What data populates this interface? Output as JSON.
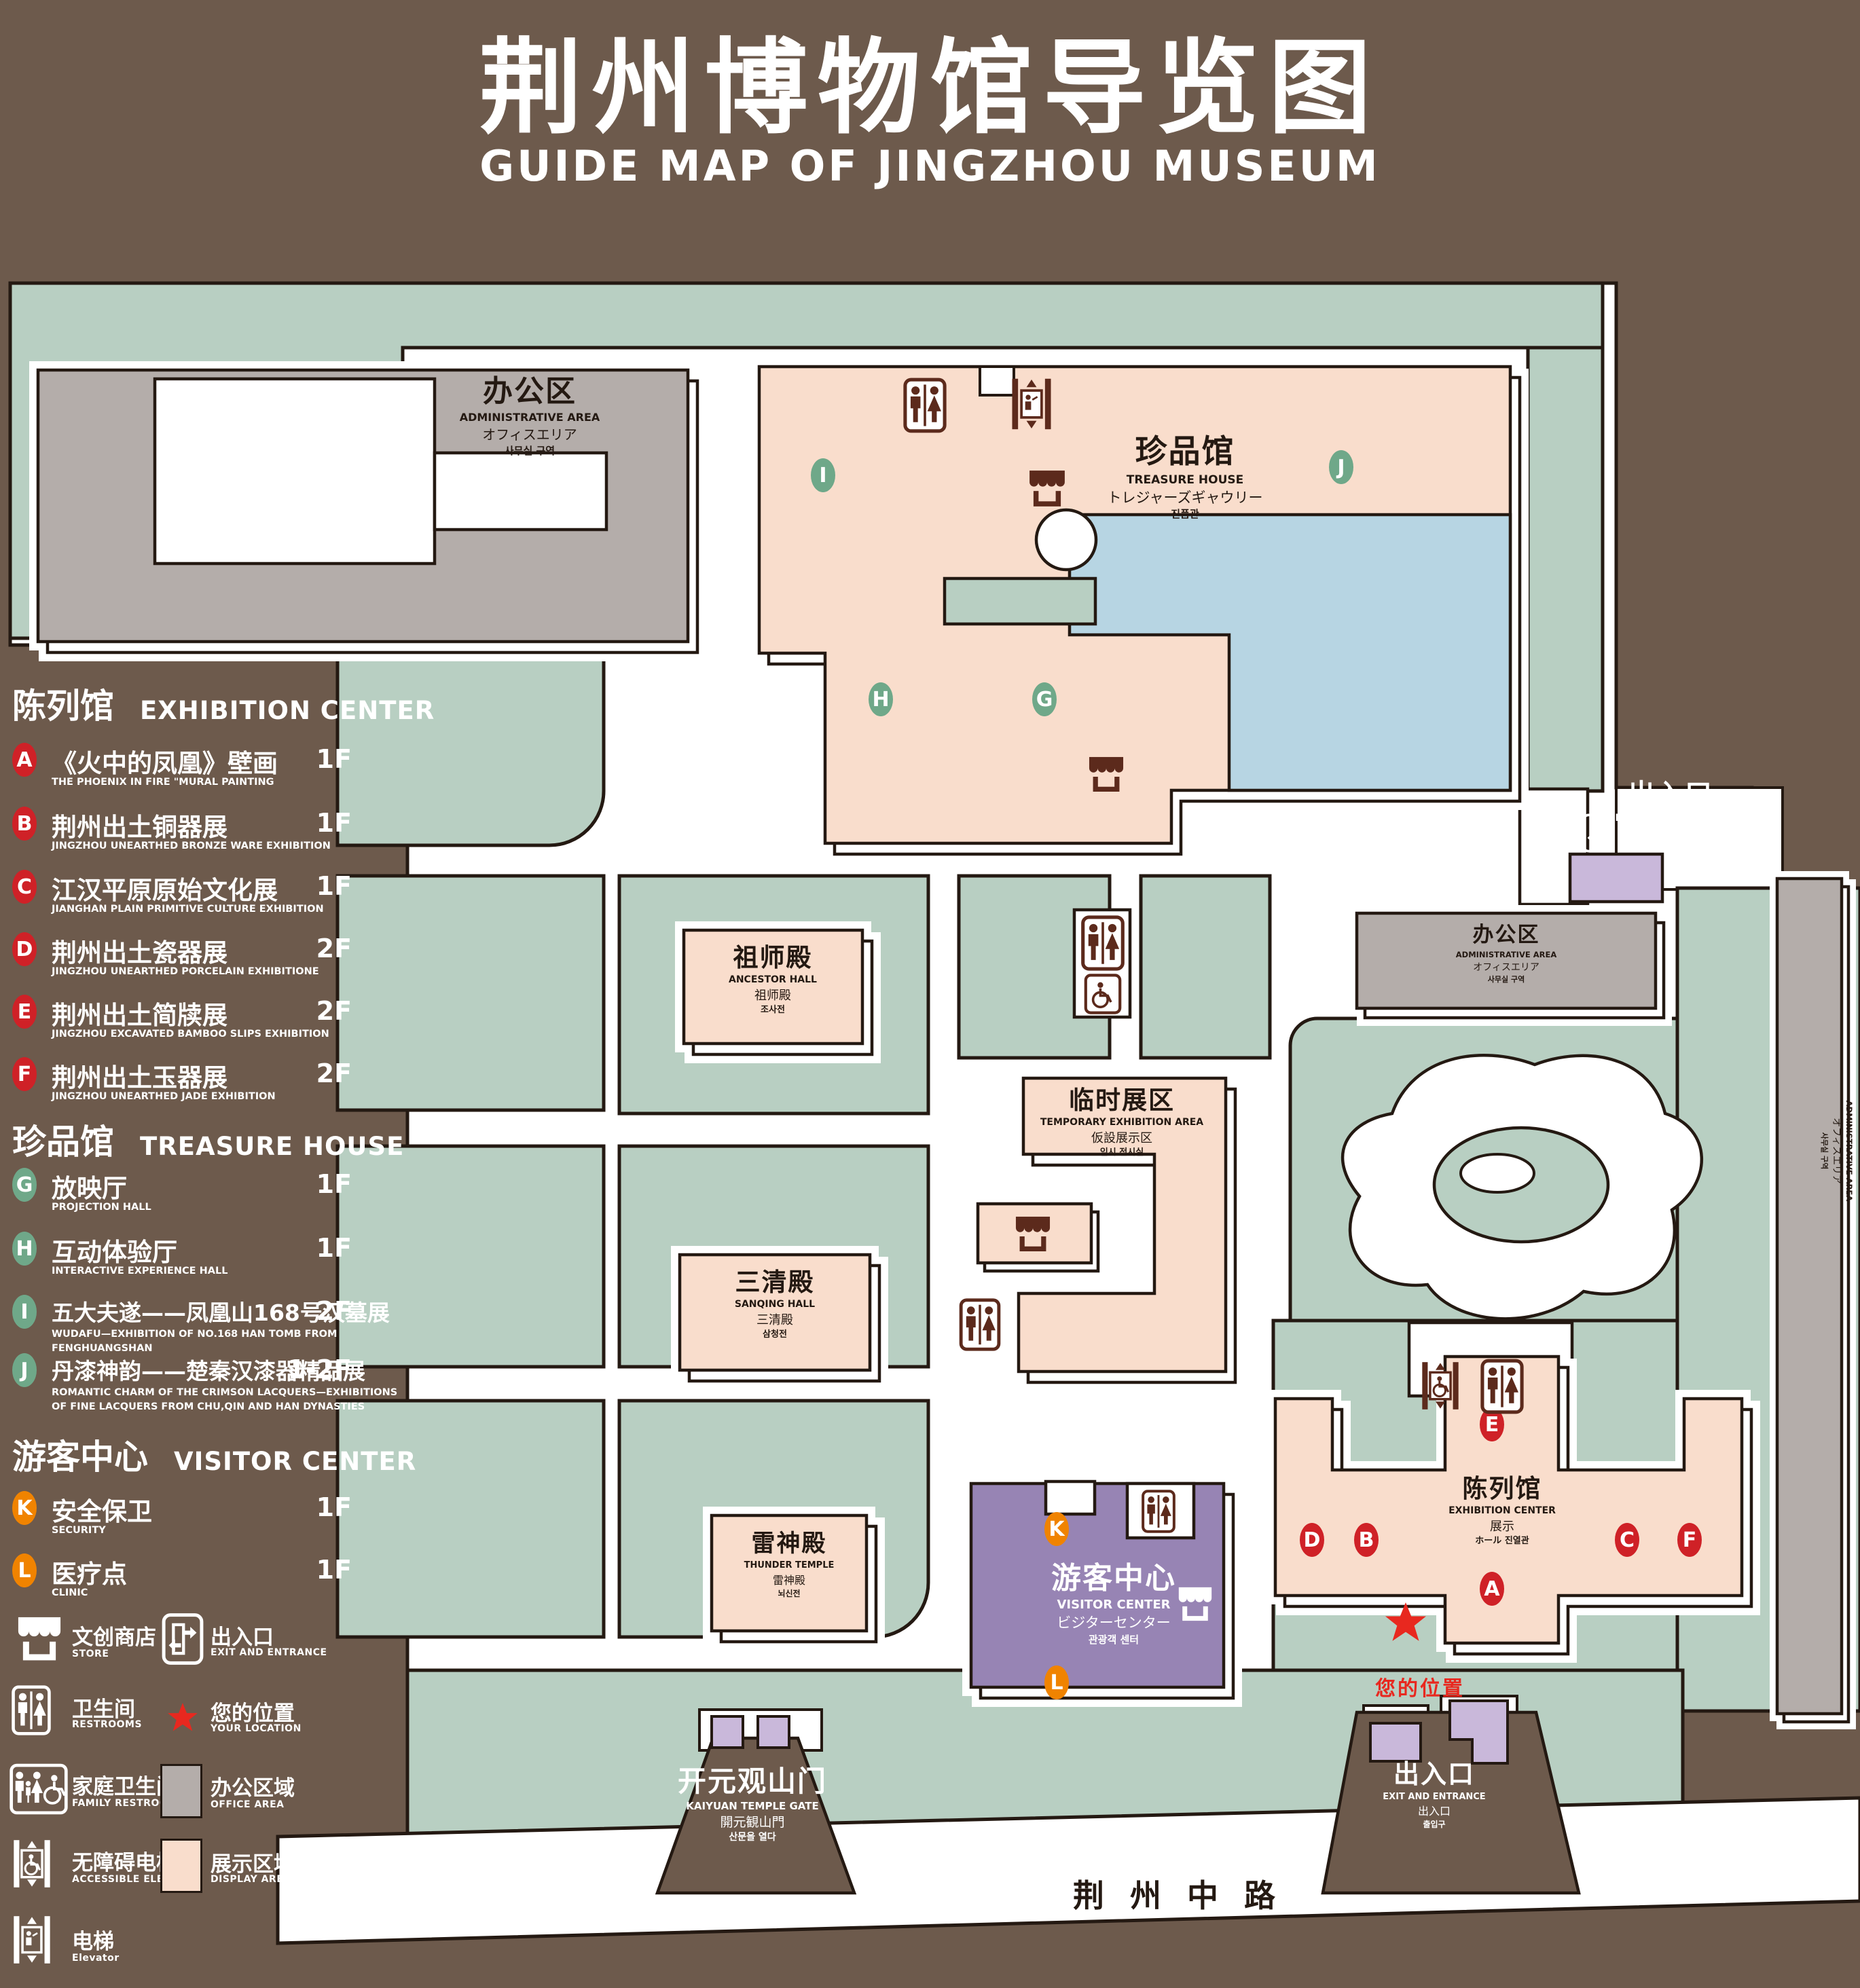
{
  "title": {
    "cn": "荆州博物馆导览图",
    "en": "GUIDE MAP OF JINGZHOU MUSEUM"
  },
  "legend": {
    "sections": [
      {
        "cn": "陈列馆",
        "en": "EXHIBITION CENTER"
      },
      {
        "cn": "珍品馆",
        "en": "TREASURE HOUSE"
      },
      {
        "cn": "游客中心",
        "en": "VISITOR CENTER"
      }
    ],
    "items": [
      {
        "code": "A",
        "cn": "《火中的凤凰》壁画",
        "en": "THE PHOENIX IN FIRE \"MURAL PAINTING",
        "floor": "1F"
      },
      {
        "code": "B",
        "cn": "荆州出土铜器展",
        "en": "JINGZHOU UNEARTHED BRONZE WARE EXHIBITION",
        "floor": "1F"
      },
      {
        "code": "C",
        "cn": "江汉平原原始文化展",
        "en": "JIANGHAN PLAIN PRIMITIVE CULTURE EXHIBITION",
        "floor": "1F"
      },
      {
        "code": "D",
        "cn": "荆州出土瓷器展",
        "en": "JINGZHOU UNEARTHED PORCELAIN EXHIBITIONE",
        "floor": "2F"
      },
      {
        "code": "E",
        "cn": "荆州出土简牍展",
        "en": "JINGZHOU EXCAVATED BAMBOO SLIPS EXHIBITION",
        "floor": "2F"
      },
      {
        "code": "F",
        "cn": "荆州出土玉器展",
        "en": "JINGZHOU UNEARTHED JADE EXHIBITION",
        "floor": "2F"
      },
      {
        "code": "G",
        "cn": "放映厅",
        "en": "PROJECTION HALL",
        "floor": "1F"
      },
      {
        "code": "H",
        "cn": "互动体验厅",
        "en": "INTERACTIVE EXPERIENCE HALL",
        "floor": "1F"
      },
      {
        "code": "I",
        "cn": "五大夫遂——凤凰山168号汉墓展",
        "en": "WUDAFU—EXHIBITION OF NO.168 HAN TOMB FROM FENGHUANGSHAN",
        "floor": "2F"
      },
      {
        "code": "J",
        "cn": "丹漆神韵——楚秦汉漆器精品展",
        "en": "ROMANTIC CHARM OF THE CRIMSON LACQUERS—EXHIBITIONS OF FINE LACQUERS FROM CHU,QIN AND HAN DYNASTIES",
        "floor": "1-2F"
      },
      {
        "code": "K",
        "cn": "安全保卫",
        "en": "SECURITY",
        "floor": "1F"
      },
      {
        "code": "L",
        "cn": "医疗点",
        "en": "CLINIC",
        "floor": "1F"
      }
    ],
    "symbols": [
      {
        "icon": "store-icon",
        "cn": "文创商店",
        "en": "STORE"
      },
      {
        "icon": "exit-icon",
        "cn": "出入口",
        "en": "EXIT AND ENTRANCE"
      },
      {
        "icon": "restroom-icon",
        "cn": "卫生间",
        "en": "RESTROOMS"
      },
      {
        "icon": "location-star-icon",
        "cn": "您的位置",
        "en": "YOUR LOCATION"
      },
      {
        "icon": "family-restroom-icon",
        "cn": "家庭卫生间",
        "en": "FAMILY RESTROOMS"
      },
      {
        "icon": "office-area-swatch",
        "cn": "办公区域",
        "en": "OFFICE AREA",
        "color": "#b4adaa"
      },
      {
        "icon": "accessible-elevator-icon",
        "cn": "无障碍电梯",
        "en": "ACCESSIBLE ELEVATOR"
      },
      {
        "icon": "display-area-swatch",
        "cn": "展示区域",
        "en": "DISPLAY AREA",
        "color": "#f9ddcc"
      },
      {
        "icon": "elevator-icon",
        "cn": "电梯",
        "en": "Elevator"
      }
    ]
  },
  "map": {
    "buildings": {
      "admin_top_left": {
        "cn": "办公区",
        "en": "ADMINISTRATIVE AREA",
        "jp": "オフィスエリア",
        "kr": "사무실 구역"
      },
      "treasure_house": {
        "cn": "珍品馆",
        "en": "TREASURE HOUSE",
        "jp": "トレジャーズギャウリー",
        "kr": "진품관"
      },
      "ancestor_hall": {
        "cn": "祖师殿",
        "en": "ANCESTOR HALL",
        "jp": "祖师殿",
        "kr": "조사전"
      },
      "temporary_exhibition": {
        "cn": "临时展区",
        "en": "TEMPORARY EXHIBITION AREA",
        "jp": "仮設展示区",
        "kr": "임시 전시실"
      },
      "sanqing_hall": {
        "cn": "三清殿",
        "en": "SANQING HALL",
        "jp": "三清殿",
        "kr": "삼청전"
      },
      "thunder_temple": {
        "cn": "雷神殿",
        "en": "THUNDER TEMPLE",
        "jp": "雷神殿",
        "kr": "뇌신전"
      },
      "visitor_center": {
        "cn": "游客中心",
        "en": "VISITOR CENTER",
        "jp": "ビジターセンター",
        "kr": "관광객 센터"
      },
      "exhibition_center": {
        "cn": "陈列馆",
        "en": "EXHIBITION CENTER",
        "jp": "展示",
        "kr": "ホール 진열관"
      },
      "admin_mid_right": {
        "cn": "办公区",
        "en": "ADMINISTRATIVE AREA",
        "jp": "オフィスエリア",
        "kr": "사무실 구역"
      },
      "admin_right_strip": {
        "cn": "办公区",
        "en": "ADMINISTRATIVE AREA",
        "jp": "オフィスエリア",
        "kr": "사무실 구역"
      }
    },
    "gate": {
      "cn": "开元观山门",
      "en": "KAIYUAN TEMPLE GATE",
      "jp": "開元観山門",
      "kr": "산문을 열다"
    },
    "exit_top_right": {
      "cn": "出入口",
      "en": "EXIT AND ENTRANCE",
      "jp": "出入口",
      "kr": "출입구"
    },
    "exit_bottom_right": {
      "cn": "出入口",
      "en": "EXIT AND ENTRANCE",
      "jp": "出入口",
      "kr": "출입구"
    },
    "road": "荆州中路",
    "your_location": "您的位置",
    "markers": [
      {
        "letter": "A"
      },
      {
        "letter": "B"
      },
      {
        "letter": "C"
      },
      {
        "letter": "D"
      },
      {
        "letter": "E"
      },
      {
        "letter": "F"
      },
      {
        "letter": "G"
      },
      {
        "letter": "H"
      },
      {
        "letter": "I"
      },
      {
        "letter": "J"
      },
      {
        "letter": "K"
      },
      {
        "letter": "L"
      }
    ]
  }
}
